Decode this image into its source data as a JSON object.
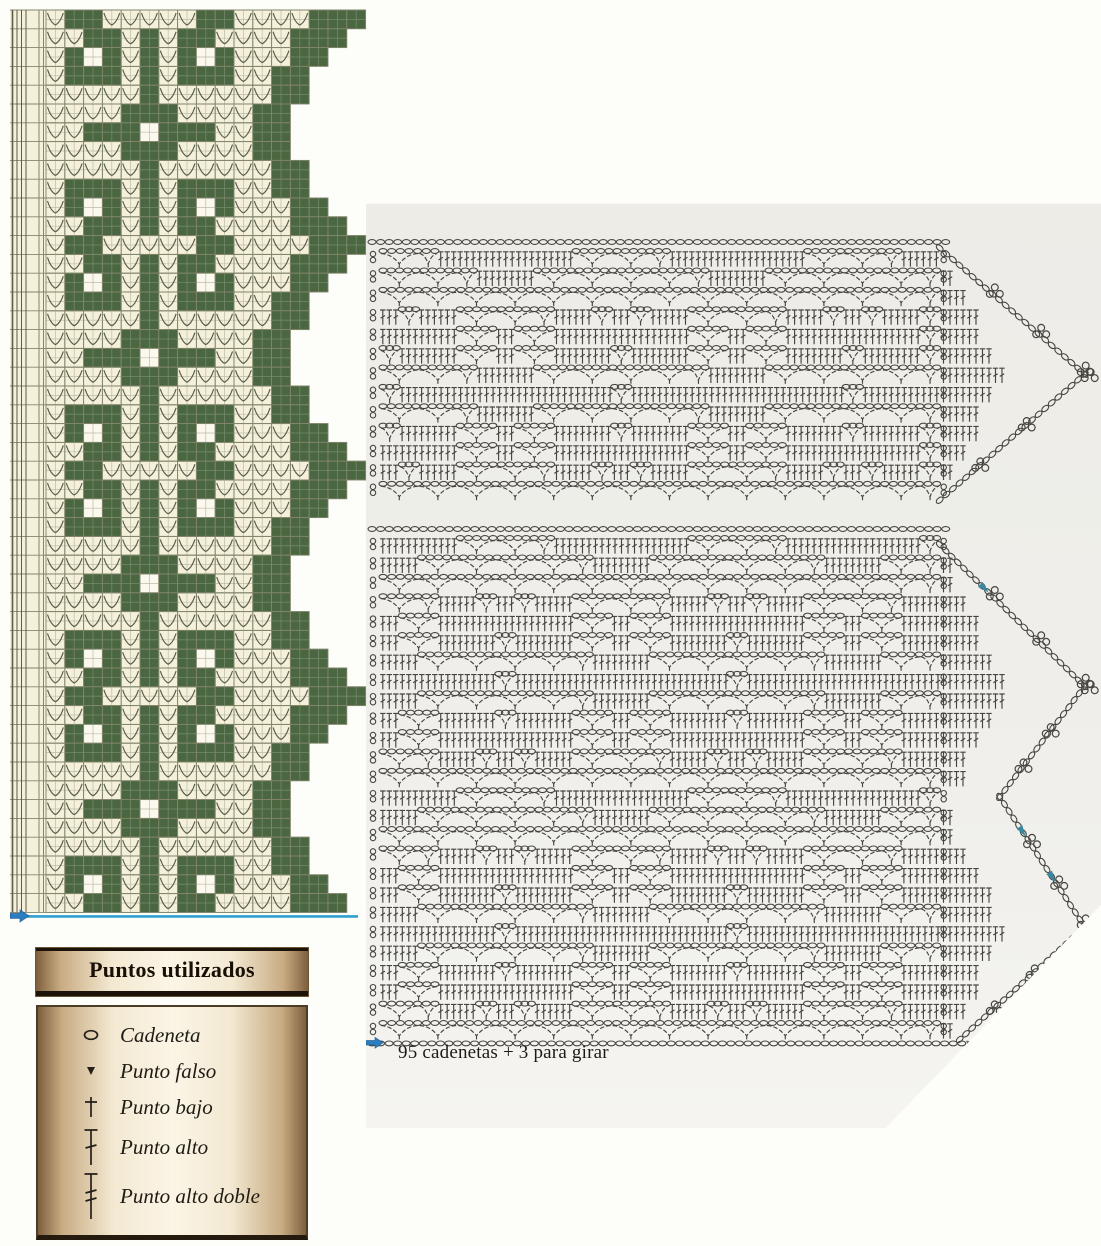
{
  "page": {
    "bg": "#fdfdfa"
  },
  "colors": {
    "cream": "#f4f0da",
    "hole": "#fbf8ee",
    "green": "#4b6741",
    "grid_major": "#82866c",
    "grid_minor": "#bcbda6",
    "arc": "#5b5e4d",
    "symbol_stroke": "#46453f",
    "baseline_blue": "#2fa0cf",
    "arrow_blue": "#2a7fc2",
    "arrow_teal": "#3a87a0",
    "arrow_red": "#c2511f",
    "legend_dark": "#1b130a"
  },
  "filet_chart": {
    "x": 10,
    "y": 8,
    "svg_w": 358,
    "svg_h": 932,
    "origin_x": 36,
    "origin_y": 2,
    "cell": 18.8,
    "repeats": 4,
    "margin_lines": [
      2.5,
      7,
      11.5,
      16,
      29,
      33.5
    ],
    "motif": [
      ".##.....##....###",
      "..##.#.##....###.",
      ".#o#.#.#o#...##..",
      ".###.#.###..##...",
      ".....#......##...",
      "....###....##....",
      "..###o###..##....",
      "....###....##....",
      ".....#......##...",
      ".###.#.###..##...",
      ".#o#.#.#o#...##..",
      "..##.#.##....###."
    ],
    "start_arrow_icon": "blue-right-arrow"
  },
  "legend": {
    "title": "Puntos utilizados",
    "items": [
      {
        "icon": "chain-stitch-icon",
        "label": "Cadeneta"
      },
      {
        "icon": "slip-stitch-icon",
        "label": "Punto falso"
      },
      {
        "icon": "single-crochet-icon",
        "label": "Punto bajo"
      },
      {
        "icon": "double-crochet-icon",
        "label": "Punto alto"
      },
      {
        "icon": "treble-crochet-icon",
        "label": "Punto alto doble"
      }
    ]
  },
  "right_panel": {
    "x": 366,
    "y": 198,
    "w": 735,
    "h": 930,
    "caption": "95 cadenetas + 3 para girar",
    "caption_pos": {
      "x": 32,
      "y": 844
    },
    "charts": [
      {
        "name": "border-symbol-chart-top",
        "x0": 14,
        "y0": 50,
        "cols": 29,
        "rows": 13,
        "cw": 19.3,
        "rh": 19.4,
        "phase": 0,
        "bottom_chain": false,
        "bottom_chain_ext": 0,
        "points": [
          {
            "start": 0,
            "peak": 6.5,
            "end": 13,
            "depth": 145,
            "startOffset": 0,
            "endOffset": 0,
            "maxCells": 5
          }
        ],
        "direction_arrows": []
      },
      {
        "name": "border-symbol-chart-bottom",
        "x0": 14,
        "y0": 337,
        "cols": 29,
        "rows": 26,
        "cw": 19.3,
        "rh": 19.4,
        "phase": 6,
        "bottom_chain": true,
        "bottom_chain_ext": 22,
        "points": [
          {
            "start": 0.5,
            "peak": 7.8,
            "end": 13.5,
            "depth": 145,
            "startOffset": 0,
            "endOffset": 60,
            "maxCells": 5
          },
          {
            "start": 13.5,
            "peak": 20.2,
            "end": 26,
            "depth": 145,
            "startOffset": 60,
            "endOffset": 20,
            "maxCells": 5
          }
        ],
        "direction_arrows": [
          {
            "point": 0,
            "edge": "asc",
            "t": 0.31
          },
          {
            "point": 1,
            "edge": "asc",
            "t": 0.27
          },
          {
            "point": 1,
            "edge": "asc",
            "t": 0.62
          }
        ],
        "start_arrow_icon": "blue-right-arrow",
        "end_arrow_icon": "red-start-arrow"
      }
    ]
  }
}
